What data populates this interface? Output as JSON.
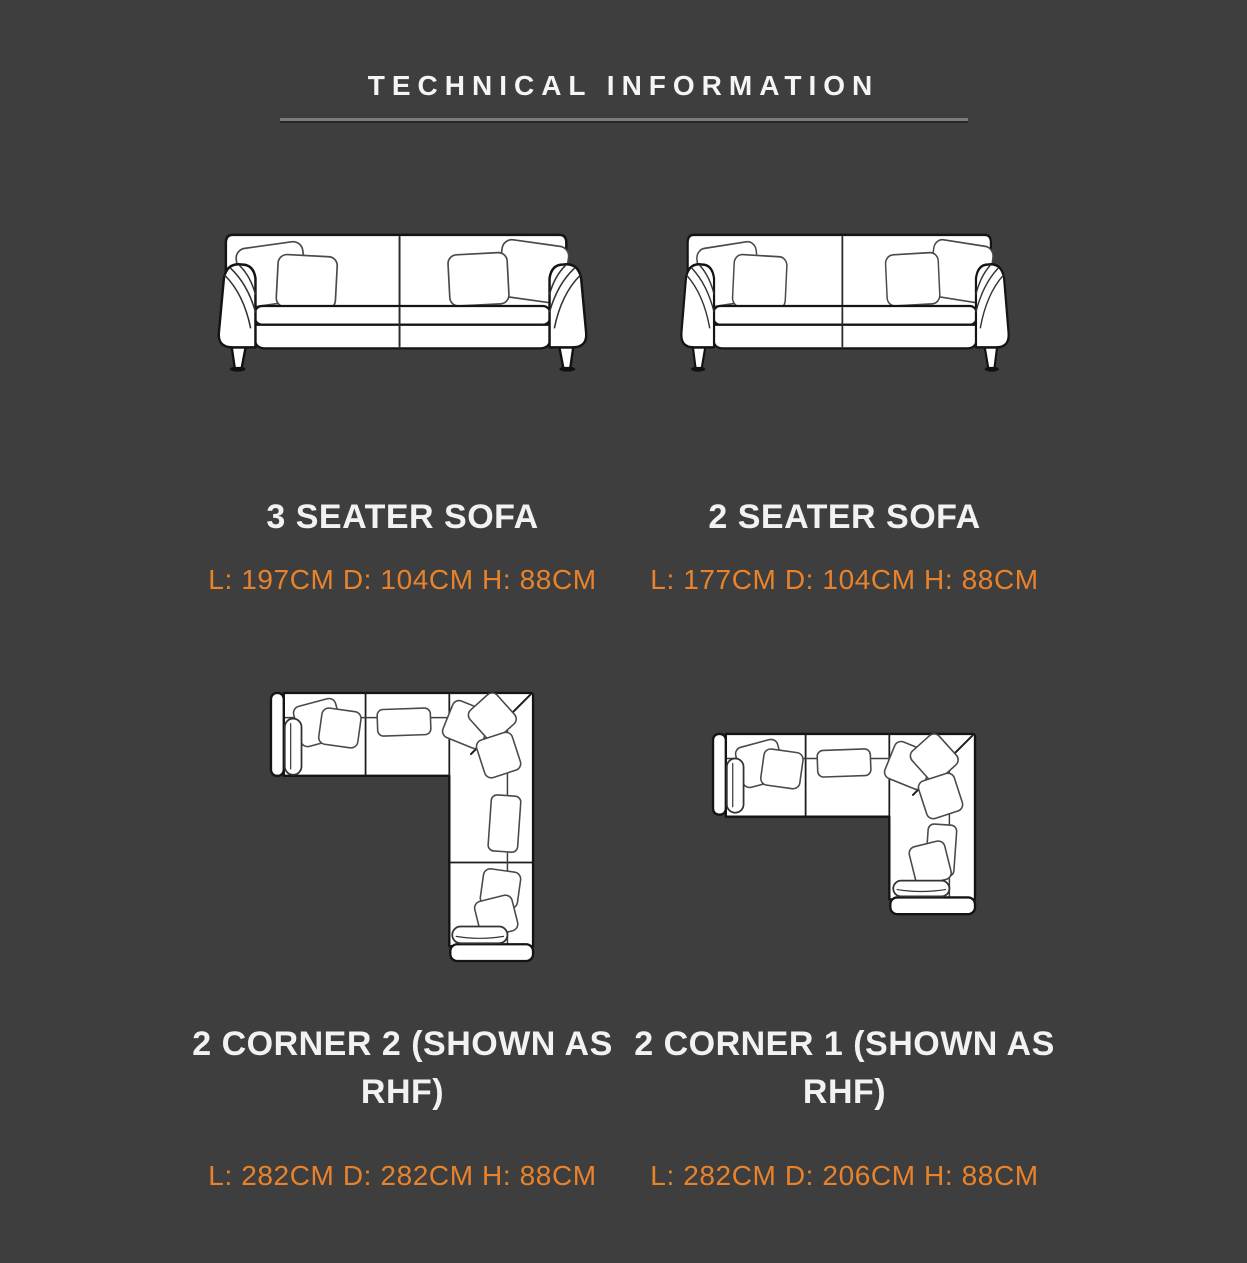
{
  "title": "TECHNICAL INFORMATION",
  "colors": {
    "background": "#3E3E3E",
    "heading_text": "#F5F5F5",
    "dimension_text": "#E8832C",
    "rule": "#7B7B7B",
    "diagram_fill": "#FFFFFF",
    "diagram_stroke": "#141414"
  },
  "products": [
    {
      "name": "3 SEATER SOFA",
      "dimensions": "L: 197CM D: 104CM H: 88CM",
      "diagram": "sofa-3-seater-front-view-diagram"
    },
    {
      "name": "2 SEATER SOFA",
      "dimensions": "L: 177CM D: 104CM H: 88CM",
      "diagram": "sofa-2-seater-front-view-diagram"
    },
    {
      "name": "2 CORNER 2 (SHOWN AS RHF)",
      "dimensions": "L: 282CM D: 282CM H: 88CM",
      "diagram": "corner-sofa-2-corner-2-top-view-diagram"
    },
    {
      "name": "2 CORNER 1 (SHOWN AS RHF)",
      "dimensions": "L: 282CM D: 206CM H: 88CM",
      "diagram": "corner-sofa-2-corner-1-top-view-diagram"
    }
  ]
}
